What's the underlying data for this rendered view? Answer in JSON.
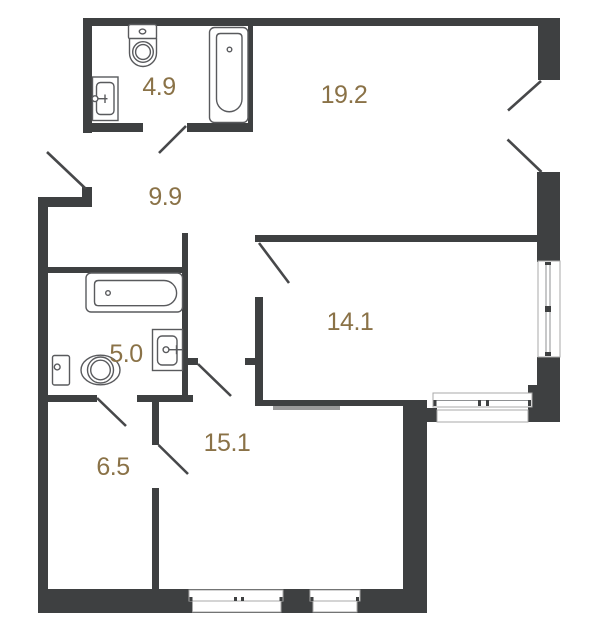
{
  "floorplan": {
    "wall_color": "#3e4041",
    "label_color": "#8a7247",
    "window_frame_color": "#a8a8a8",
    "rooms": [
      {
        "id": "bathroom-top",
        "area": "4.9"
      },
      {
        "id": "living-room",
        "area": "19.2"
      },
      {
        "id": "hallway",
        "area": "9.9"
      },
      {
        "id": "bedroom",
        "area": "14.1"
      },
      {
        "id": "bathroom-left",
        "area": "5.0"
      },
      {
        "id": "kitchen-room",
        "area": "15.1"
      },
      {
        "id": "inner-hall",
        "area": "6.5"
      }
    ]
  }
}
